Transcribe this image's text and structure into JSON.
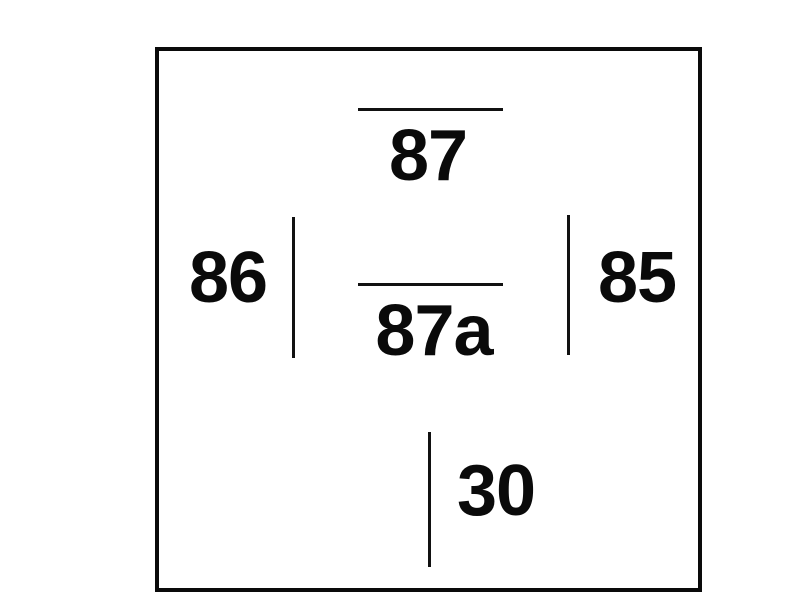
{
  "diagram": {
    "type": "relay-pin-diagram",
    "background_color": "#ffffff",
    "line_color": "#111111",
    "outline_color": "#0a0a0a",
    "text_color": "#0a0a0a",
    "pins": [
      {
        "id": "87",
        "label": "87",
        "position": "top-center",
        "terminal_line": "horizontal"
      },
      {
        "id": "87a",
        "label": "87a",
        "position": "center",
        "terminal_line": "horizontal"
      },
      {
        "id": "86",
        "label": "86",
        "position": "middle-left",
        "terminal_line": "vertical"
      },
      {
        "id": "85",
        "label": "85",
        "position": "middle-right",
        "terminal_line": "vertical"
      },
      {
        "id": "30",
        "label": "30",
        "position": "bottom-center",
        "terminal_line": "vertical"
      }
    ]
  }
}
